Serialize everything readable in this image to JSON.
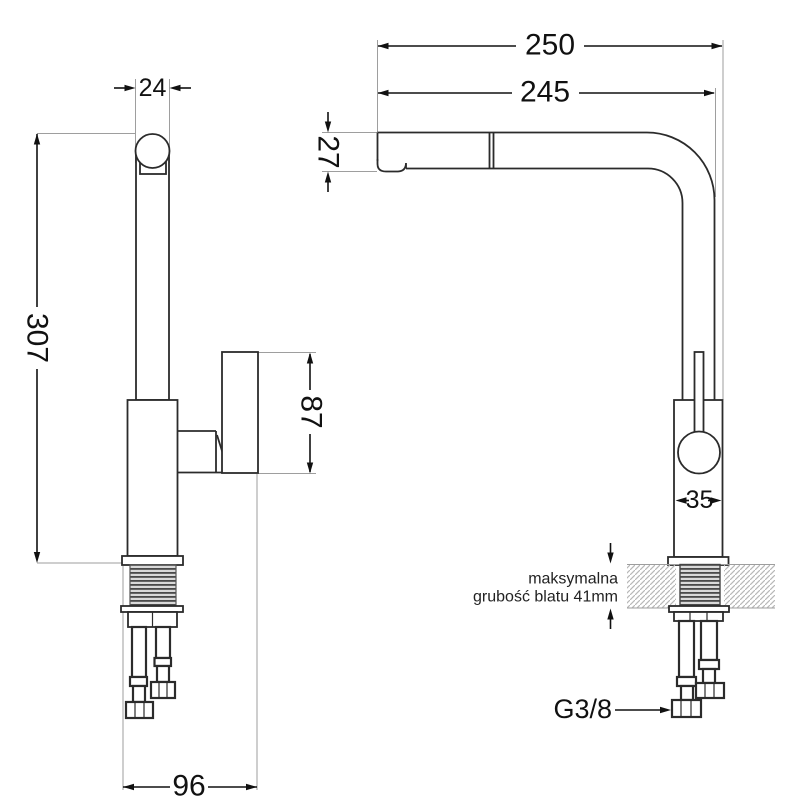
{
  "drawing": {
    "type": "faucet-installation-dimensions",
    "front_view": {
      "spout_top_width": "24",
      "total_height": "307",
      "handle_height": "87",
      "base_clearance_width": "96"
    },
    "side_view": {
      "total_reach": "250",
      "spout_reach": "245",
      "spout_tip_height": "27",
      "body_width": "35",
      "counter_note_line1": "maksymalna",
      "counter_note_line2": "grubość blatu 41mm",
      "hose_thread_label": "G3/8"
    },
    "colors": {
      "background": "#ffffff",
      "outline": "#2b2b2b",
      "dimension": "#111111",
      "extension": "#9e9e9e",
      "hatch": "#b8b8b8",
      "thread_dark": "#4a4a4a"
    }
  }
}
